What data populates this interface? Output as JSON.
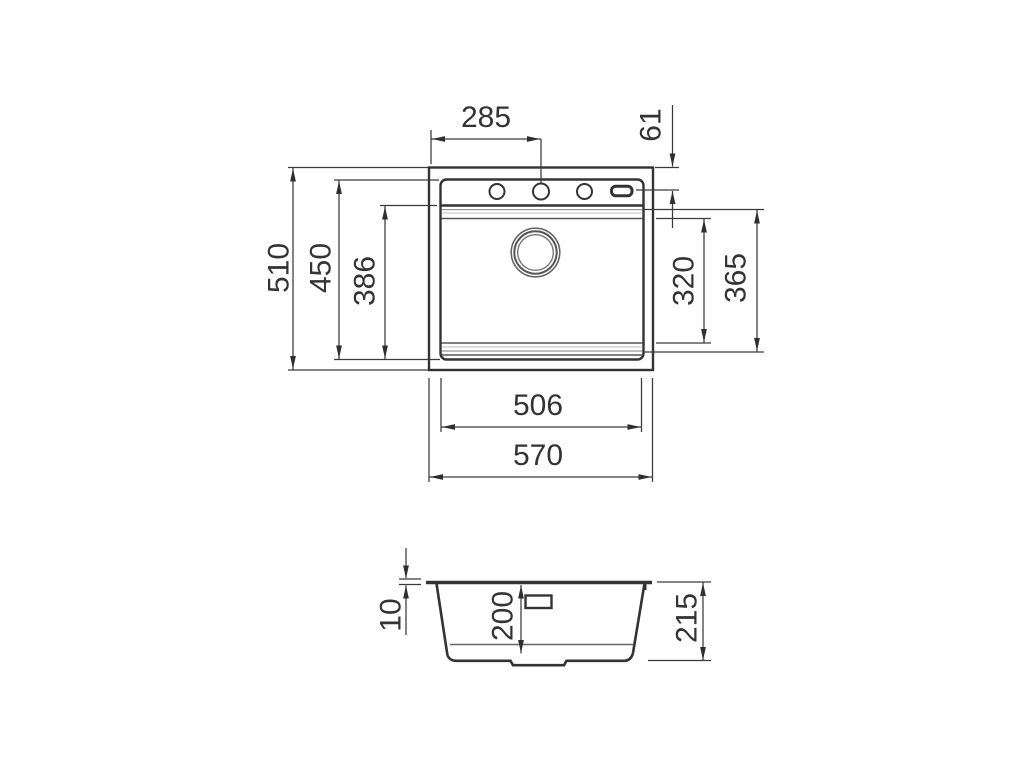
{
  "colors": {
    "background": "#ffffff",
    "line_main": "#333333",
    "line_dim": "#3a3a3a",
    "line_step_light": "#9a9a9a",
    "text": "#333333"
  },
  "dims": {
    "tap_hole_from_left": "285",
    "tap_hole_from_top": "61",
    "overall_front_to_back": "510",
    "inner_front_to_back": "450",
    "bowl_front_to_back": "386",
    "bowl_inner_front_to_back": "320",
    "bowl_outer_front_to_back": "365",
    "inner_width": "506",
    "overall_width": "570",
    "rim_height": "10",
    "bowl_depth": "200",
    "overall_height": "215"
  }
}
